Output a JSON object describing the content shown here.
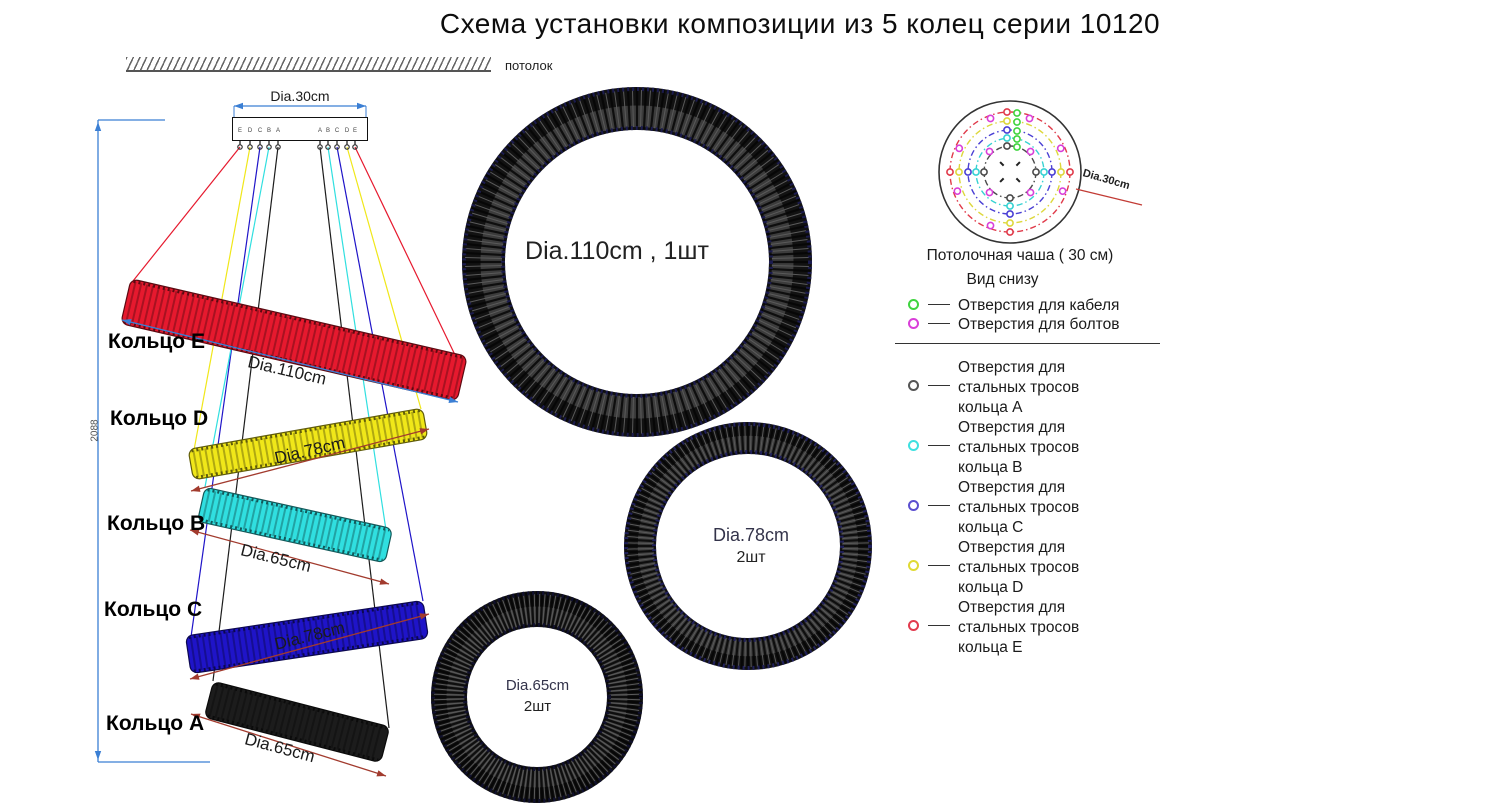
{
  "title": "Схема установки композиции из 5 колец серии 10120",
  "side_view": {
    "ceiling_label": "потолок",
    "plate_dim": "Dia.30cm",
    "height_dim": "2088",
    "hook_letters_left": [
      "E",
      "D",
      "C",
      "B",
      "A"
    ],
    "hook_letters_right": [
      "A",
      "B",
      "C",
      "D",
      "E"
    ],
    "rings": [
      {
        "id": "E",
        "label": "Кольцо E",
        "dim": "Dia.110cm",
        "color": "#e6192e"
      },
      {
        "id": "D",
        "label": "Кольцо D",
        "dim": "Dia.78cm",
        "color": "#f0e719"
      },
      {
        "id": "B",
        "label": "Кольцо B",
        "dim": "Dia.65cm",
        "color": "#30dfe0"
      },
      {
        "id": "C",
        "label": "Кольцо C",
        "dim": "Dia.78cm",
        "color": "#1f14c8"
      },
      {
        "id": "A",
        "label": "Кольцо A",
        "dim": "Dia.65cm",
        "color": "#1c1c1c"
      }
    ],
    "dim_colors": {
      "blue": "#3b7fd4",
      "darkred": "#a23b2e"
    }
  },
  "top_views": [
    {
      "id": "big",
      "label": "Dia.110cm , 1шт",
      "qty": ""
    },
    {
      "id": "medium",
      "label": "Dia.78cm",
      "qty": "2шт"
    },
    {
      "id": "small",
      "label": "Dia.65cm",
      "qty": "2шт"
    }
  ],
  "cup": {
    "title1": "Потолочная чаша ( 30 см)",
    "title2": "Вид снизу",
    "dim_label": "Dia.30cm",
    "circles": [
      {
        "ring": "A",
        "color": "#4a4a4a"
      },
      {
        "ring": "B",
        "color": "#36d2d2"
      },
      {
        "ring": "C",
        "color": "#4a3fd4"
      },
      {
        "ring": "D",
        "color": "#ddd73b"
      },
      {
        "ring": "E",
        "color": "#e03a4a"
      }
    ],
    "hole_colors": {
      "cable": "#3fd43f",
      "bolt": "#d93fd9"
    },
    "legend_top": [
      {
        "color": "#3fd43f",
        "text": "Отверстия для кабеля"
      },
      {
        "color": "#d93fd9",
        "text": "Отверстия для болтов"
      }
    ],
    "legend_rings": [
      {
        "color": "#555555",
        "lines": [
          "Отверстия для",
          "стальных тросов",
          "кольца A"
        ]
      },
      {
        "color": "#3fe0e0",
        "lines": [
          "Отверстия для",
          "стальных тросов",
          "кольца B"
        ]
      },
      {
        "color": "#5b4fd0",
        "lines": [
          "Отверстия для",
          "стальных тросов",
          "кольца C"
        ]
      },
      {
        "color": "#e0da35",
        "lines": [
          "Отверстия для",
          "стальных тросов",
          "кольца D"
        ]
      },
      {
        "color": "#e23b4e",
        "lines": [
          "Отверстия для",
          "стальных тросов",
          "кольца E"
        ]
      }
    ]
  }
}
